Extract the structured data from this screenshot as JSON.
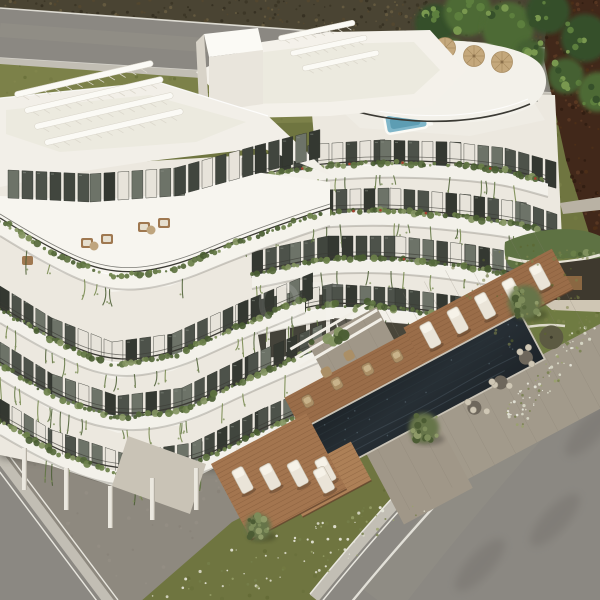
{
  "scene": {
    "description": "Aerial 3D architectural rendering of a modern white apartment complex with curved balconies covered in cascading greenery, rooftop pergolas and straw parasols, a dark outdoor pool with wooden sun decks, lawns, olive trees, a green-roofed garden pavilion and surrounding asphalt roads",
    "watermark": "OT"
  },
  "inventory": {
    "visible_floors": 5,
    "rooftop_parasols": 3,
    "sun_loungers": 10,
    "wicker_chairs": 4,
    "pool_side_tables": 3,
    "olive_trees": 3,
    "wooden_decks": 3,
    "roads": 3,
    "rooftop_pergolas": 2,
    "garden_pergola": 1,
    "penthouse_plunge_pool": 1,
    "green_roof_pavilion": 1
  },
  "palette": {
    "grass": "#6f7540",
    "grass_light": "#7c8149",
    "grass_dark": "#5c652f",
    "scrub": "#4a4433",
    "scrub_dark": "#322d1f",
    "scrub_light": "#6a5f42",
    "tree": "#4d6a35",
    "tree_dark": "#36502a",
    "tree_light": "#79984f",
    "maroon": "#41281a",
    "road": "#8b8882",
    "road_light": "#979489",
    "sidewalk": "#c2beb4",
    "curb": "#e9e7df",
    "asphalt": "#6e6b66",
    "apron": "#8e897f",
    "white": "#f3f1ea",
    "white_bright": "#fbfaf5",
    "white_dim": "#e7e3da",
    "wall_shade": "#d5d0c5",
    "slab_edge": "#cfc9bd",
    "railing": "#3b3a34",
    "glass": "#4d524a",
    "glass_dark": "#343831",
    "glass_light": "#6d7368",
    "plant": "#5e7340",
    "plant_dark": "#495c31",
    "plant_light": "#839460",
    "flower_red": "#a63f2e",
    "pool": "#20262b",
    "pool_mid": "#2c363d",
    "ripple": "#45525b",
    "wood": "#9a6d49",
    "wood_dark": "#744e31",
    "wood_light": "#ad8057",
    "stone": "#a29a8b",
    "stone_dark": "#8c857a",
    "lounger": "#eae4d8",
    "wicker": "#ab8f66",
    "parasol": "#c4a87c",
    "plunge": "#7fb6c9",
    "interior": "#3e392e"
  }
}
